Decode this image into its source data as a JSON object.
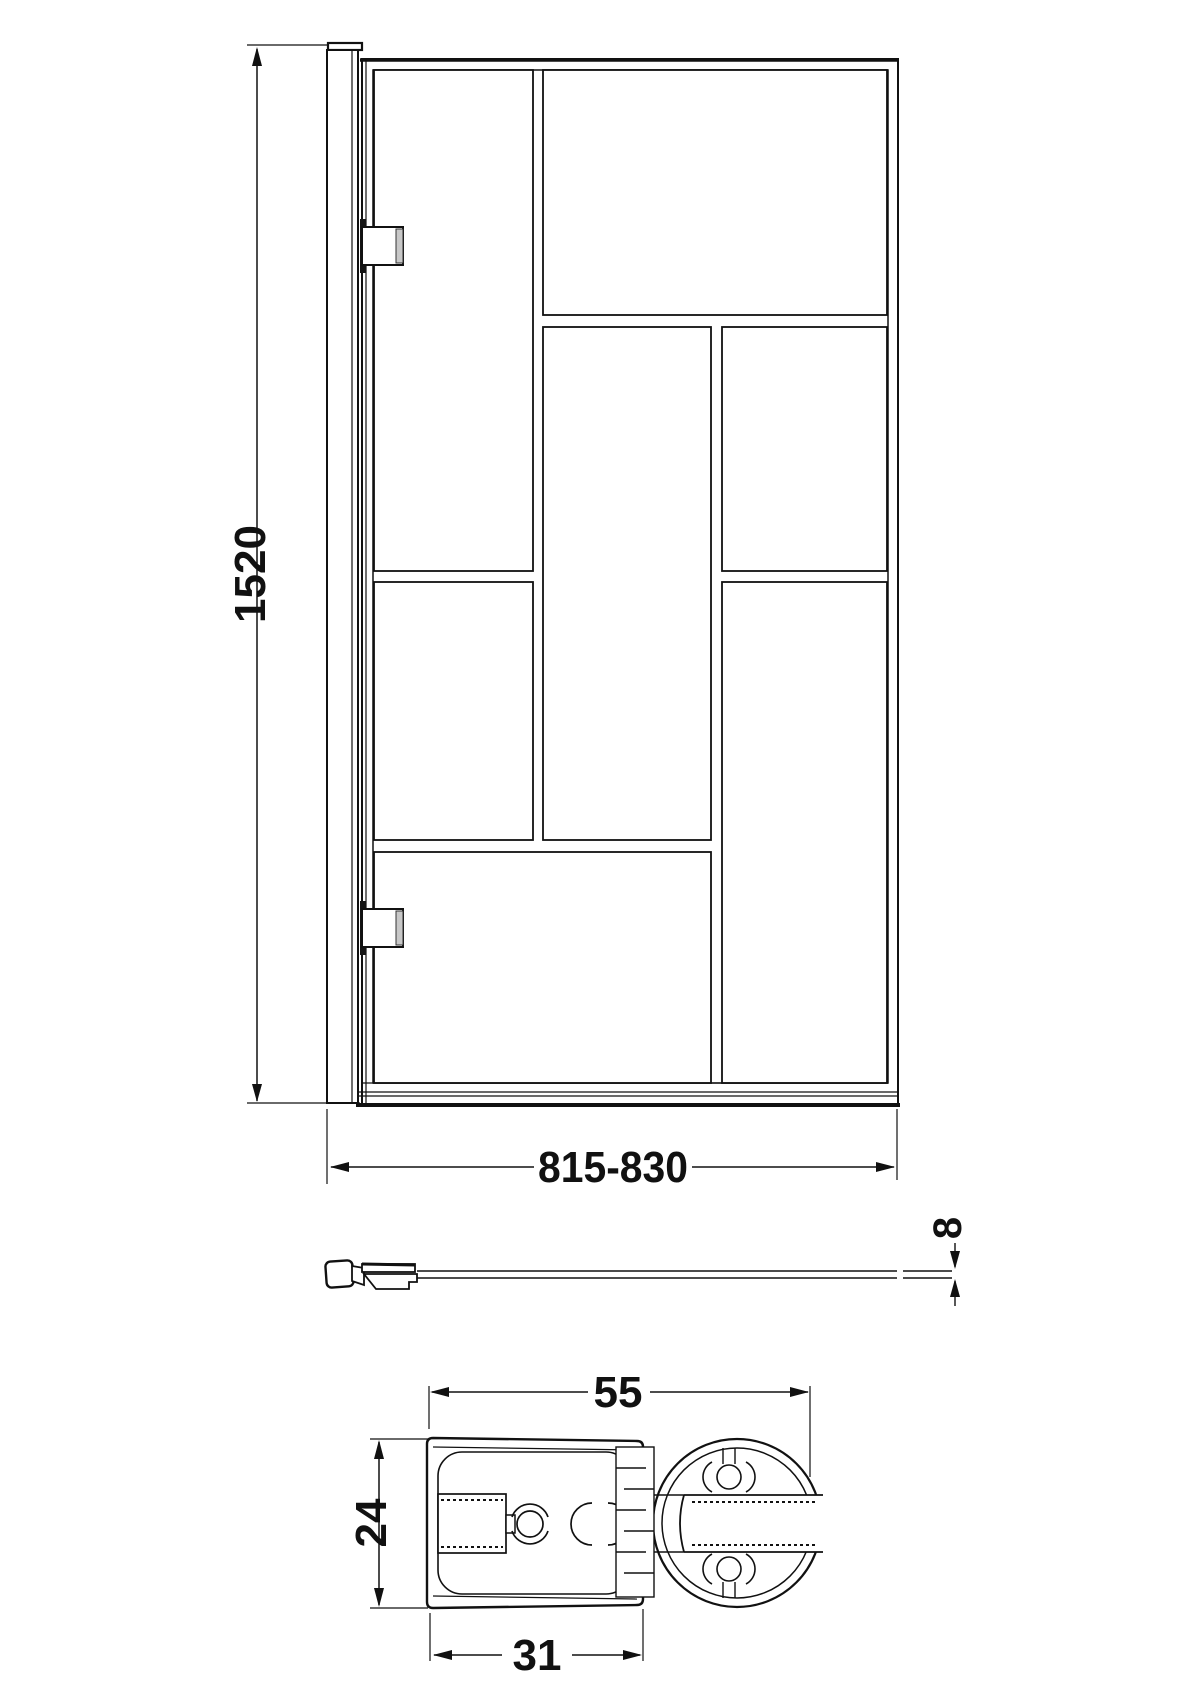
{
  "drawing_type": "technical-dimension-drawing",
  "style": {
    "background": "#ffffff",
    "line_color": "#111111",
    "hinge_lip_fill": "#c8c8c8",
    "hinge_back_fill": "#151515"
  },
  "dimensions": {
    "overall_height": {
      "label": "1520"
    },
    "overall_width": {
      "label": "815-830"
    },
    "glass_thickness": {
      "label": "8"
    },
    "section_depth": {
      "label": "55"
    },
    "section_height": {
      "label": "24"
    },
    "section_channel_width": {
      "label": "31"
    }
  }
}
